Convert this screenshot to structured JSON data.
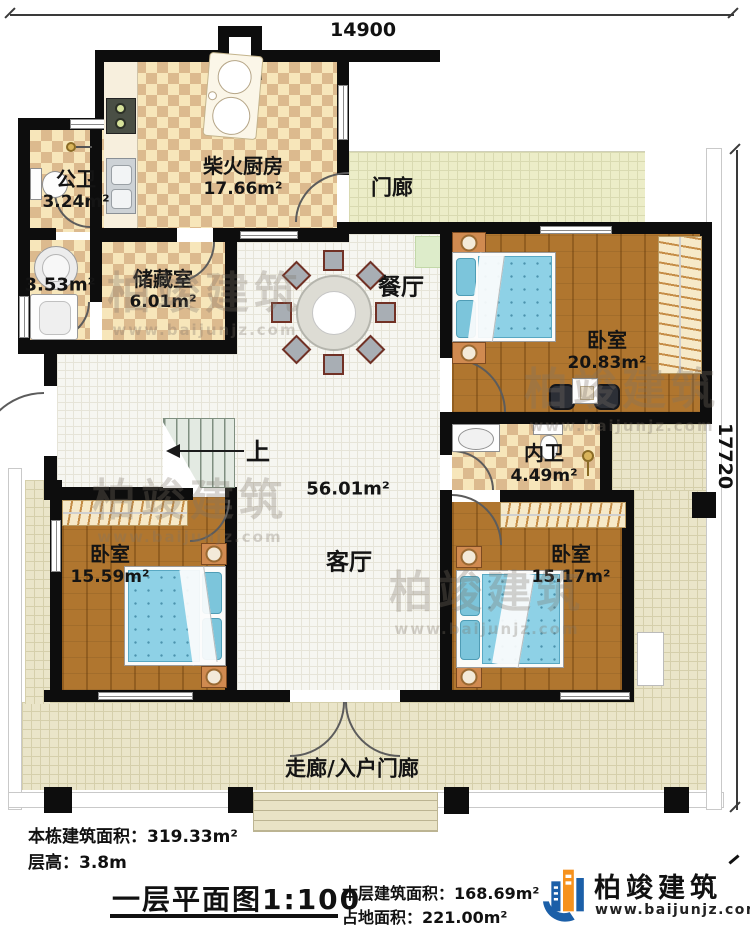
{
  "dimensions": {
    "top": "14900",
    "right": "17720"
  },
  "rooms": [
    {
      "name": "公卫",
      "area": "3.24m²"
    },
    {
      "name": "",
      "area": "3.53m²"
    },
    {
      "name": "储藏室",
      "area": "6.01m²"
    },
    {
      "name": "柴火厨房",
      "area": "17.66m²"
    },
    {
      "name": "门廊",
      "area": ""
    },
    {
      "name": "餐厅",
      "area": ""
    },
    {
      "name": "卧室",
      "area": "20.83m²"
    },
    {
      "name": "内卫",
      "area": "4.49m²"
    },
    {
      "name": "客厅",
      "area": "56.01m²"
    },
    {
      "name": "卧室",
      "area": "15.59m²"
    },
    {
      "name": "卧室",
      "area": "15.17m²"
    },
    {
      "name": "走廊/入户门廊",
      "area": ""
    }
  ],
  "stairs": {
    "label": "上"
  },
  "footer": {
    "building_area_label": "本栋建筑面积：",
    "building_area_value": "319.33m²",
    "floor_height_label": "层高：",
    "floor_height_value": "3.8m",
    "title": "一层平面图",
    "scale": "1:100",
    "floor_area_label": "本层建筑面积：",
    "floor_area_value": "168.69m²",
    "land_area_label": "占地面积：",
    "land_area_value": "221.00m²"
  },
  "logo": {
    "name": "柏竣建筑",
    "url": "www.baijunjz.com"
  },
  "watermark": {
    "text": "柏竣建筑",
    "url": "www.baijunjz.com"
  },
  "colors": {
    "wall": "#0d0d0d",
    "checker_light": "#f7e6ba",
    "checker_dark": "#dcba8e",
    "wood_floor": "#b0762f",
    "bed_blue": "#8ed1e6",
    "logo_blue": "#1b5fa8",
    "logo_orange": "#f6921e"
  }
}
